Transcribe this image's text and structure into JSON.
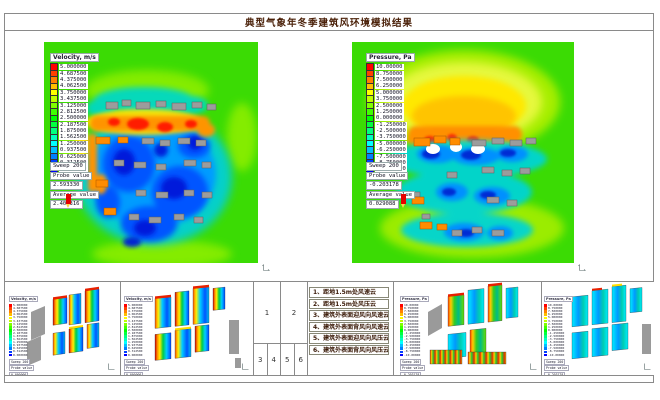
{
  "title": "典型气象年冬季建筑风环境模拟结果",
  "field_green": "#3bdb04",
  "velocity_legend": {
    "title": "Velocity, m/s",
    "rows": [
      {
        "c": "#ff0000",
        "v": "5.000000"
      },
      {
        "c": "#ff4000",
        "v": "4.687500"
      },
      {
        "c": "#ff8000",
        "v": "4.375000"
      },
      {
        "c": "#ffbf00",
        "v": "4.062500"
      },
      {
        "c": "#ffff00",
        "v": "3.750000"
      },
      {
        "c": "#bfff00",
        "v": "3.437500"
      },
      {
        "c": "#80ff00",
        "v": "3.125000"
      },
      {
        "c": "#40ff00",
        "v": "2.812500"
      },
      {
        "c": "#00ff00",
        "v": "2.500000"
      },
      {
        "c": "#00ff40",
        "v": "2.187500"
      },
      {
        "c": "#00ff80",
        "v": "1.875000"
      },
      {
        "c": "#00ffbf",
        "v": "1.562500"
      },
      {
        "c": "#00ffff",
        "v": "1.250000"
      },
      {
        "c": "#00bfff",
        "v": "0.937500"
      },
      {
        "c": "#0080ff",
        "v": "0.625000"
      },
      {
        "c": "#0040ff",
        "v": "0.312500"
      },
      {
        "c": "#0000ff",
        "v": "0.000000"
      }
    ]
  },
  "pressure_legend": {
    "title": "Pressure, Pa",
    "rows": [
      {
        "c": "#ff0000",
        "v": "10.00000"
      },
      {
        "c": "#ff4000",
        "v": "8.750000"
      },
      {
        "c": "#ff8000",
        "v": "7.500000"
      },
      {
        "c": "#ffbf00",
        "v": "6.250000"
      },
      {
        "c": "#ffff00",
        "v": "5.000000"
      },
      {
        "c": "#bfff00",
        "v": "3.750000"
      },
      {
        "c": "#80ff00",
        "v": "2.500000"
      },
      {
        "c": "#40ff00",
        "v": "1.250000"
      },
      {
        "c": "#00ff00",
        "v": "0.000000"
      },
      {
        "c": "#00ff40",
        "v": "-1.250000"
      },
      {
        "c": "#00ff80",
        "v": "-2.500000"
      },
      {
        "c": "#00ffbf",
        "v": "-3.750000"
      },
      {
        "c": "#00ffff",
        "v": "-5.000000"
      },
      {
        "c": "#00bfff",
        "v": "-6.250000"
      },
      {
        "c": "#0080ff",
        "v": "-7.500000"
      },
      {
        "c": "#0040ff",
        "v": "-8.750000"
      },
      {
        "c": "#0000ff",
        "v": "-10.00000"
      }
    ]
  },
  "plots": {
    "velocity_plan": {
      "sweep": "Sweep 200",
      "probe_label": "Probe value",
      "probe_value": "2.593330",
      "average_label": "Average value",
      "average_value": "2.402316"
    },
    "pressure_plan": {
      "sweep": "Sweep 200",
      "probe_label": "Probe value",
      "probe_value": "-0.203178",
      "average_label": "Average value",
      "average_value": "0.029088"
    }
  },
  "panels": {
    "velocity_windward": {
      "sweep": "Sweep 200",
      "probe_label": "Probe value",
      "probe_value": "0.000000"
    },
    "velocity_leeward": {
      "sweep": "Sweep 200",
      "probe_label": "Probe value",
      "probe_value": "0.000000"
    },
    "pressure_windward": {
      "sweep": "Sweep 200",
      "probe_label": "Probe value",
      "probe_value": "-0.203178"
    },
    "pressure_leeward": {
      "sweep": "Sweep 200",
      "probe_label": "Probe value",
      "probe_value": "-0.203178"
    }
  },
  "layout_key": {
    "top": [
      "1",
      "2"
    ],
    "bottom": [
      "3",
      "4",
      "5",
      "6"
    ]
  },
  "list_items": [
    "1、距地1.5m处风速云",
    "2、距地1.5m处风压云",
    "3、建筑外表面迎风向风速云",
    "4、建筑外表面背风向风速云",
    "5、建筑外表面迎风向风压云",
    "6、建筑外表面背风向风压云"
  ]
}
